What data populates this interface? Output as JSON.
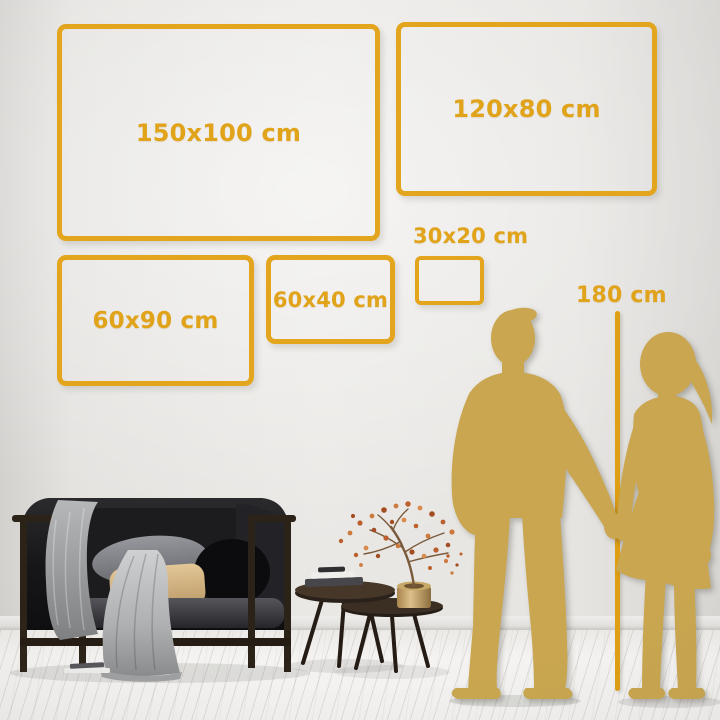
{
  "guide": {
    "sizes": [
      {
        "label": "150x100 cm"
      },
      {
        "label": "120x80 cm"
      },
      {
        "label": "60x90 cm"
      },
      {
        "label": "60x40 cm"
      },
      {
        "label": "30x20 cm"
      }
    ],
    "reference_height": {
      "label": "180 cm"
    }
  },
  "colors": {
    "accent_gold": "#E2A51D",
    "silhouette_gold": "#C9A64F",
    "wall": "#E8E6E3",
    "floor": "#F3F2F0"
  },
  "scene": {
    "people": "couple-holding-hands-silhouette",
    "furniture": [
      "dark-sofa-with-gray-blanket",
      "nesting-coffee-tables",
      "brass-vase-with-blossom-branches"
    ]
  }
}
